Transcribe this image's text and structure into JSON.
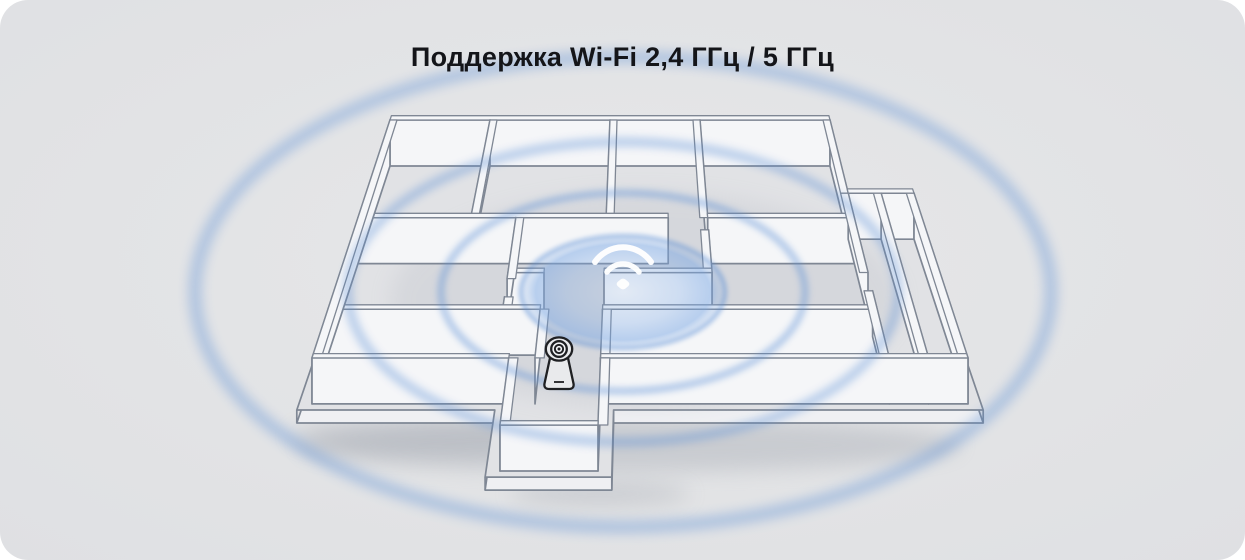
{
  "title": "Поддержка Wi-Fi 2,4 ГГц / 5 ГГц",
  "scene": {
    "outside_background": "#ffffff",
    "background": "#e3e4e6",
    "title_color": "#141519",
    "line_color": "#7f8794",
    "wall_color": "#f5f6f8",
    "floor_color": "#e1e2e5",
    "slab_face_color": "#eff0f3",
    "accent_color": "#5b8fd6",
    "glow_color": "#7aa7e4",
    "wifi_icon_color": "#ffffff",
    "camera_icon_color": "#1f2023",
    "ripple_count": 4
  }
}
